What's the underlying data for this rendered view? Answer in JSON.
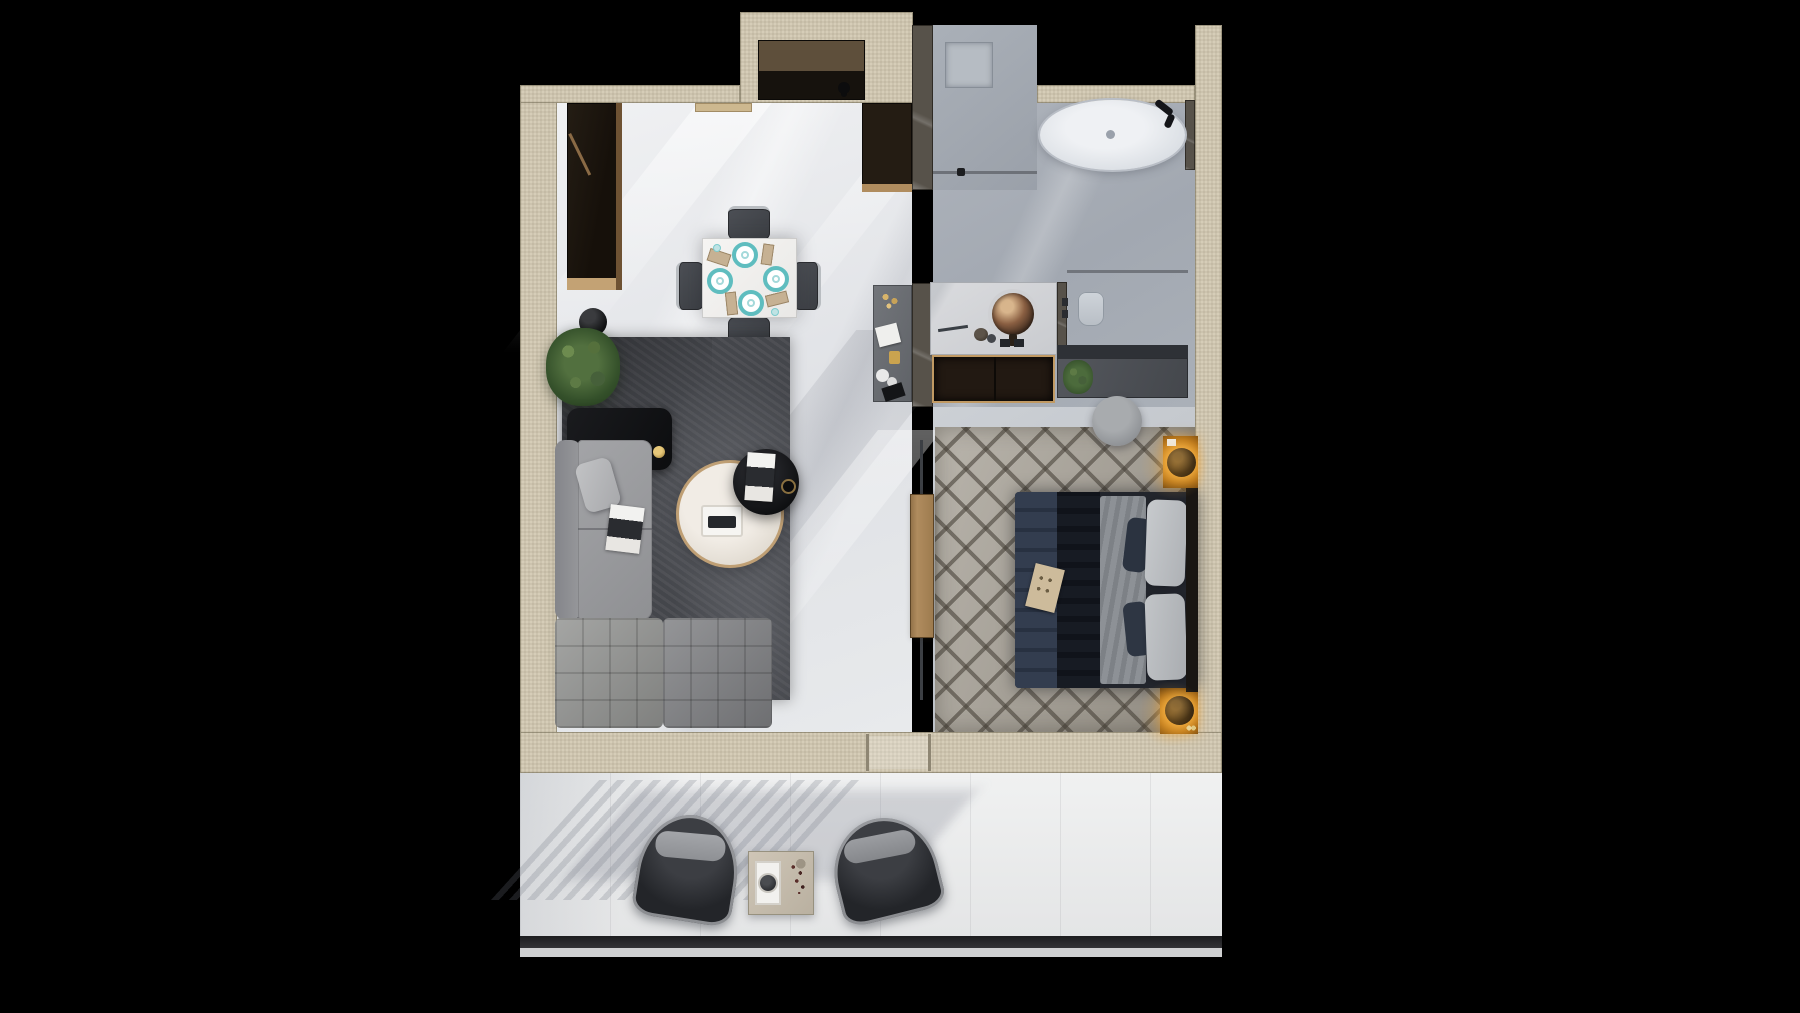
{
  "scene": {
    "type": "apartment-floor-plan-3d-render",
    "view": "top-down",
    "background": "black",
    "rooms": [
      {
        "name": "entry-hall",
        "items": [
          "entry-closet",
          "shoe-cabinet",
          "door-threshold",
          "dressing-desk"
        ]
      },
      {
        "name": "living-dining-area",
        "items": [
          "wardrobe",
          "dining-table",
          "dining-chairs-4",
          "teal-plates-4",
          "plant",
          "plant-vase",
          "media-console",
          "candle",
          "sofa-l-shaped",
          "throw-pillow",
          "magazines",
          "round-coffee-table",
          "serving-tray",
          "black-side-table",
          "dark-area-rug"
        ]
      },
      {
        "name": "bathroom",
        "items": [
          "walk-in-shower",
          "shower-drain",
          "glass-partition",
          "freestanding-bathtub",
          "tub-faucet",
          "vanity-counter",
          "vessel-sink",
          "vanity-cabinet",
          "toilet",
          "storage-counter",
          "plant-small"
        ]
      },
      {
        "name": "bedroom",
        "items": [
          "patterned-rug",
          "double-bed",
          "navy-duvet",
          "gray-blanket",
          "pillows",
          "headboard",
          "breakfast-card",
          "nightstand-amber-2",
          "sphere-lamp-2",
          "round-pouf",
          "sliding-wood-door"
        ]
      },
      {
        "name": "balcony",
        "items": [
          "lounge-chair-left",
          "lounge-chair-right",
          "stone-side-table",
          "coffee-pot-tray",
          "flower-sprig",
          "railing"
        ]
      }
    ],
    "counts": {
      "dining_plates": 4,
      "dining_chairs": 4,
      "balcony_chairs": 2,
      "nightstands": 2,
      "bed_pillows": 2
    }
  },
  "colors": {
    "background": "#000000",
    "wall": "#d6cdb8",
    "floor-living": "#e9ebee",
    "floor-bath": "#a9afb8",
    "floor-bedroom": "#c2c6cc",
    "floor-balcony": "#eceded",
    "rug-living": "#44464b",
    "rug-bedroom": "#a59f94",
    "sofa": "#9b9c9f",
    "wood": "#b08c5e",
    "furniture-black": "#121316",
    "marble-pillar": "#57524a",
    "cabinet-dark": "#221912",
    "counter-dark": "#4b4e54",
    "bed-navy": "#2f3947",
    "bed-blanket": "#878b90",
    "pillow": "#c0c3c7",
    "accent-amber": "#e09a2e",
    "accent-teal": "#5fbdbf",
    "tub-white": "#e8ebee",
    "plant-green": "#3f5c33",
    "railing-dark": "#28282a"
  }
}
